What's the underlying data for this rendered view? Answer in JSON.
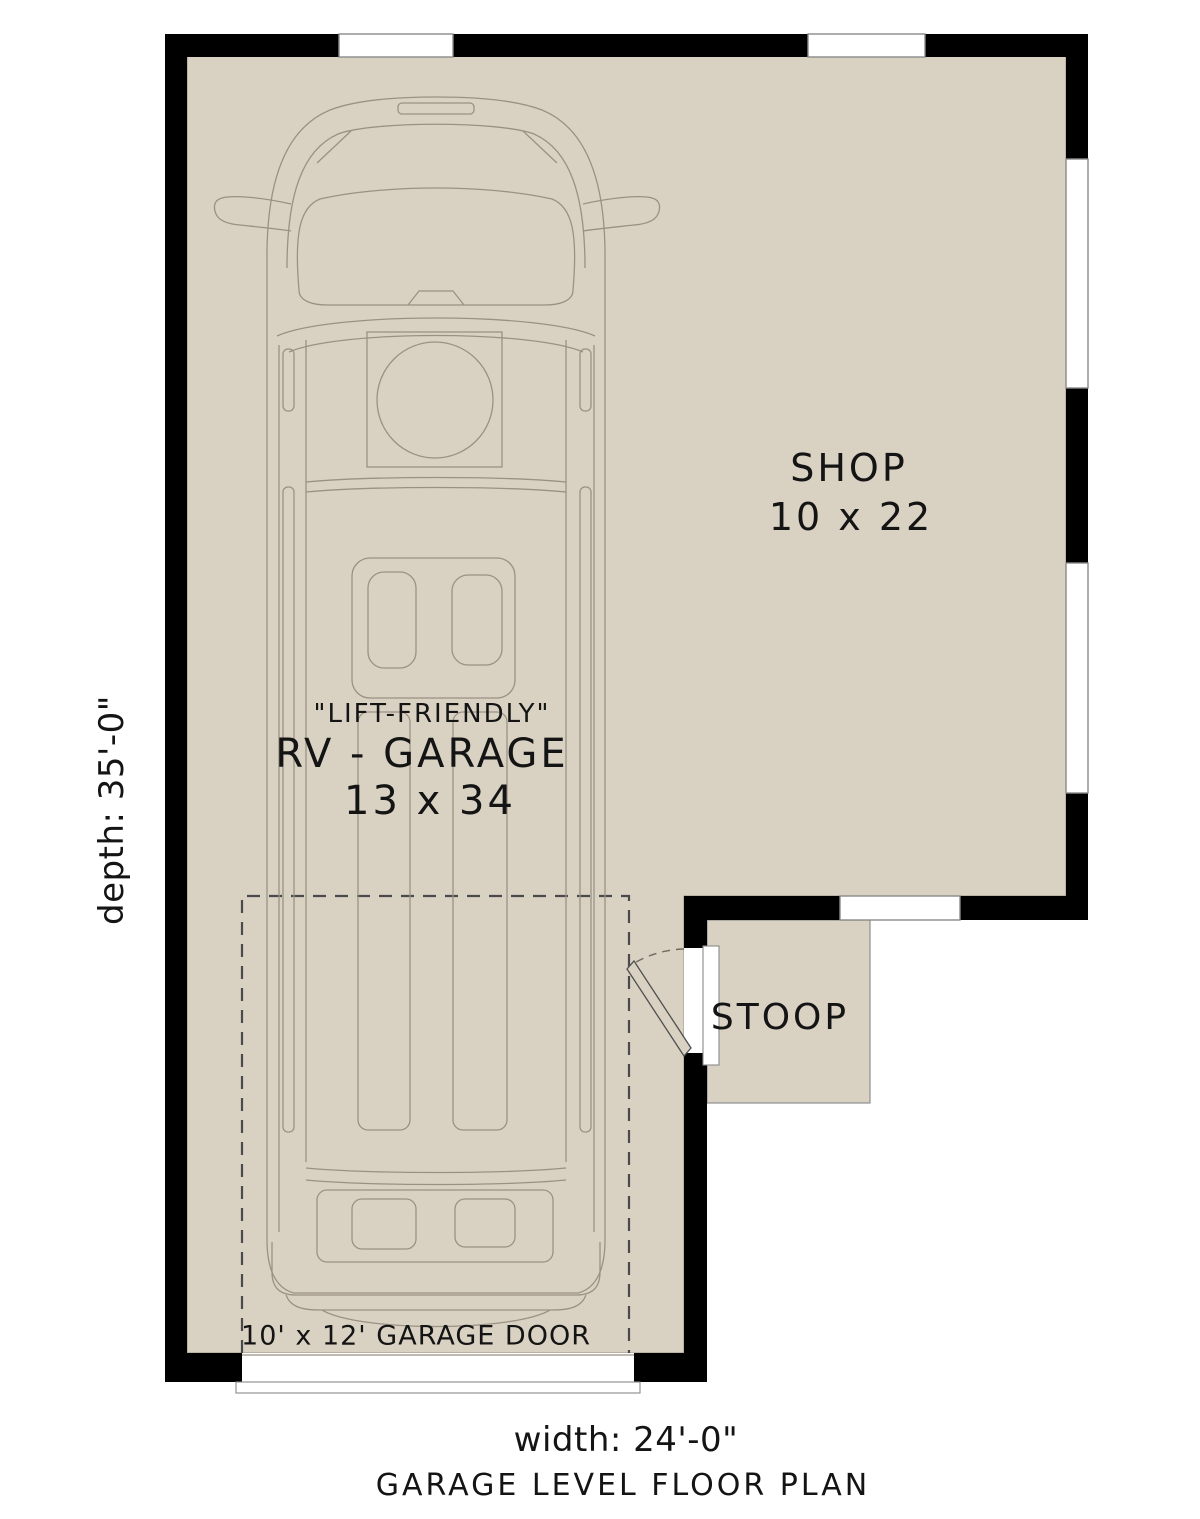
{
  "colors": {
    "floor": "#d9d2c3",
    "wall": "#000000",
    "line": "#9b9183",
    "dash": "#4a4a4a",
    "text": "#141414",
    "bg": "#ffffff",
    "window_stroke": "#8a8a8a"
  },
  "plan": {
    "title": "GARAGE LEVEL FLOOR PLAN",
    "rooms": {
      "shop": {
        "name": "SHOP",
        "dims": "10 x 22"
      },
      "rv_garage": {
        "note": "\"LIFT-FRIENDLY\"",
        "name": "RV - GARAGE",
        "dims": "13 x 34"
      },
      "stoop": {
        "name": "STOOP"
      }
    },
    "garage_door": {
      "label": "10' x 12' GARAGE DOOR"
    },
    "dimensions": {
      "width": "width: 24'-0\"",
      "depth": "depth: 35'-0\""
    }
  }
}
